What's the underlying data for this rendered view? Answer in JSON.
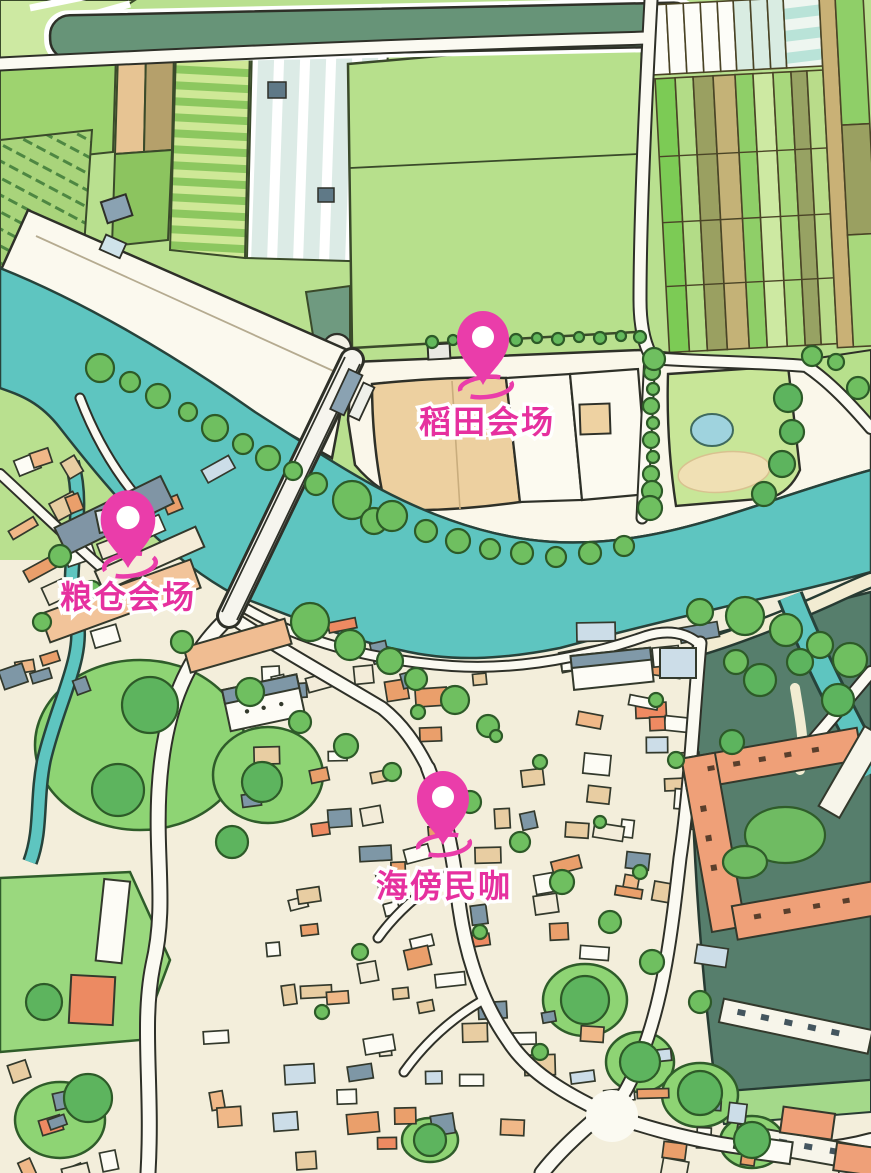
{
  "map": {
    "kind": "illustrated-aerial-town-map",
    "markers": [
      {
        "id": "rice-field-venue",
        "label": "稻田会场"
      },
      {
        "id": "granary-venue",
        "label": "粮仓会场"
      },
      {
        "id": "seaside-cafe",
        "label": "海傍民咖"
      }
    ],
    "colors": {
      "marker_pink": "#ea3daa",
      "label_pink": "#e6309f",
      "river_teal": "#5ec5c0",
      "field_green": "#b7e08c",
      "village_cream": "#f3eedb",
      "dark_park_green": "#567e6c",
      "building_orange": "#efa078",
      "tree_green": "#6fbf60"
    }
  }
}
